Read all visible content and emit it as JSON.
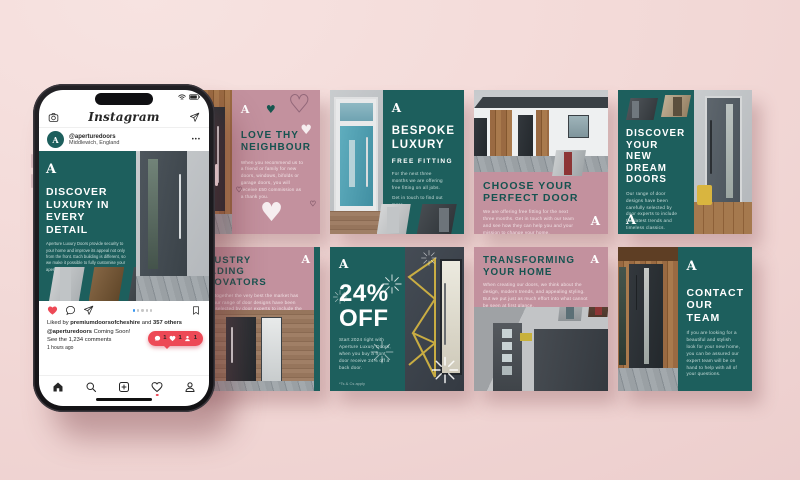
{
  "colors": {
    "background": "#f2d8d6",
    "teal": "#1d5f5d",
    "mauve": "#c3919e",
    "title_teal": "#155350",
    "instagram_red": "#ed4956",
    "carousel_blue": "#3897f0"
  },
  "logo": "A",
  "decor": {
    "heart": "♥"
  },
  "icons": {
    "header": [
      "camera-icon",
      "direct-message-icon"
    ],
    "status": [
      "wifi-icon",
      "battery-icon"
    ],
    "actions": [
      "heart-icon",
      "comment-icon",
      "share-icon",
      "bookmark-icon"
    ],
    "nav": [
      "home-icon",
      "search-icon",
      "new-post-icon",
      "activity-icon",
      "profile-icon"
    ],
    "badge": [
      "comment-icon",
      "heart-icon",
      "follower-icon"
    ]
  },
  "phone": {
    "app_title": "Instagram",
    "username": "@aperturedoors",
    "location": "Middlewich, England",
    "more": "•••",
    "post_title": "DISCOVER LUXURY IN EVERY DETAIL",
    "post_body": "Aperture Luxury Doors provide security to your home and improve its appeal not only from the front. Each building is different, so we make it possible to fully customise your aperture door.",
    "likes_prefix": "Liked by ",
    "likes_user": "premiumdoorsofcheshire",
    "likes_mid": " and ",
    "likes_count": "357 others",
    "caption_user": "@aperturedoors",
    "caption_text": " Coming Soon!",
    "comments_link": "See the 1,234 comments",
    "timestamp": "1 hours ago",
    "badge": {
      "comments": "1",
      "likes": "1",
      "followers": "1"
    }
  },
  "posts": [
    {
      "id": "love-thy-neighbour",
      "title": "LOVE THY NEIGHBOUR",
      "body": "When you recommend us to a friend or family for new doors, windows, bifolds or garage doors, you will receive £50 commission as a thank you."
    },
    {
      "id": "bespoke-luxury",
      "title": "BESPOKE LUXURY",
      "subtitle": "FREE FITTING",
      "body": "For the next three months we are offering free fitting on all jobs.",
      "body2": "Get in touch to find out more."
    },
    {
      "id": "choose-your-perfect-door",
      "title": "CHOOSE YOUR PERFECT DOOR",
      "body": "We are offering free fitting for the next three months. Get in touch with our team and see how they can help you and your mission to change your home."
    },
    {
      "id": "discover-your-new-dream-doors",
      "title": "DISCOVER YOUR NEW DREAM DOORS",
      "body": "Our range of door designs have been carefully selected by door experts to include the latest trends and timeless classics."
    },
    {
      "id": "industry-leading-innovators",
      "title": "INDUSTRY LEADING INNOVATORS",
      "body": "Bringing together the very best the market has to offer, our range of door designs have been carefully selected by door experts to include the latest trends timeless classics."
    },
    {
      "id": "24-percent-off",
      "title_line1": "24%",
      "title_line2": "OFF",
      "body": "Start 2024 right with Aperture Luxury Doors, when you buy a front door receive 24% off a back door.",
      "footnote": "*Ts & Cs apply"
    },
    {
      "id": "transforming-your-home",
      "title": "TRANSFORMING YOUR HOME",
      "body": "When creating our doors, we think about the design, modern trends, and appealing styling. But we put just as much effort into what cannot be seen at first glance."
    },
    {
      "id": "contact-our-team",
      "title": "CONTACT OUR TEAM",
      "body": "If you are looking for a beautiful and stylish look for your new home, you can be assured our expert team will be on hand to help with all of your questions."
    }
  ]
}
